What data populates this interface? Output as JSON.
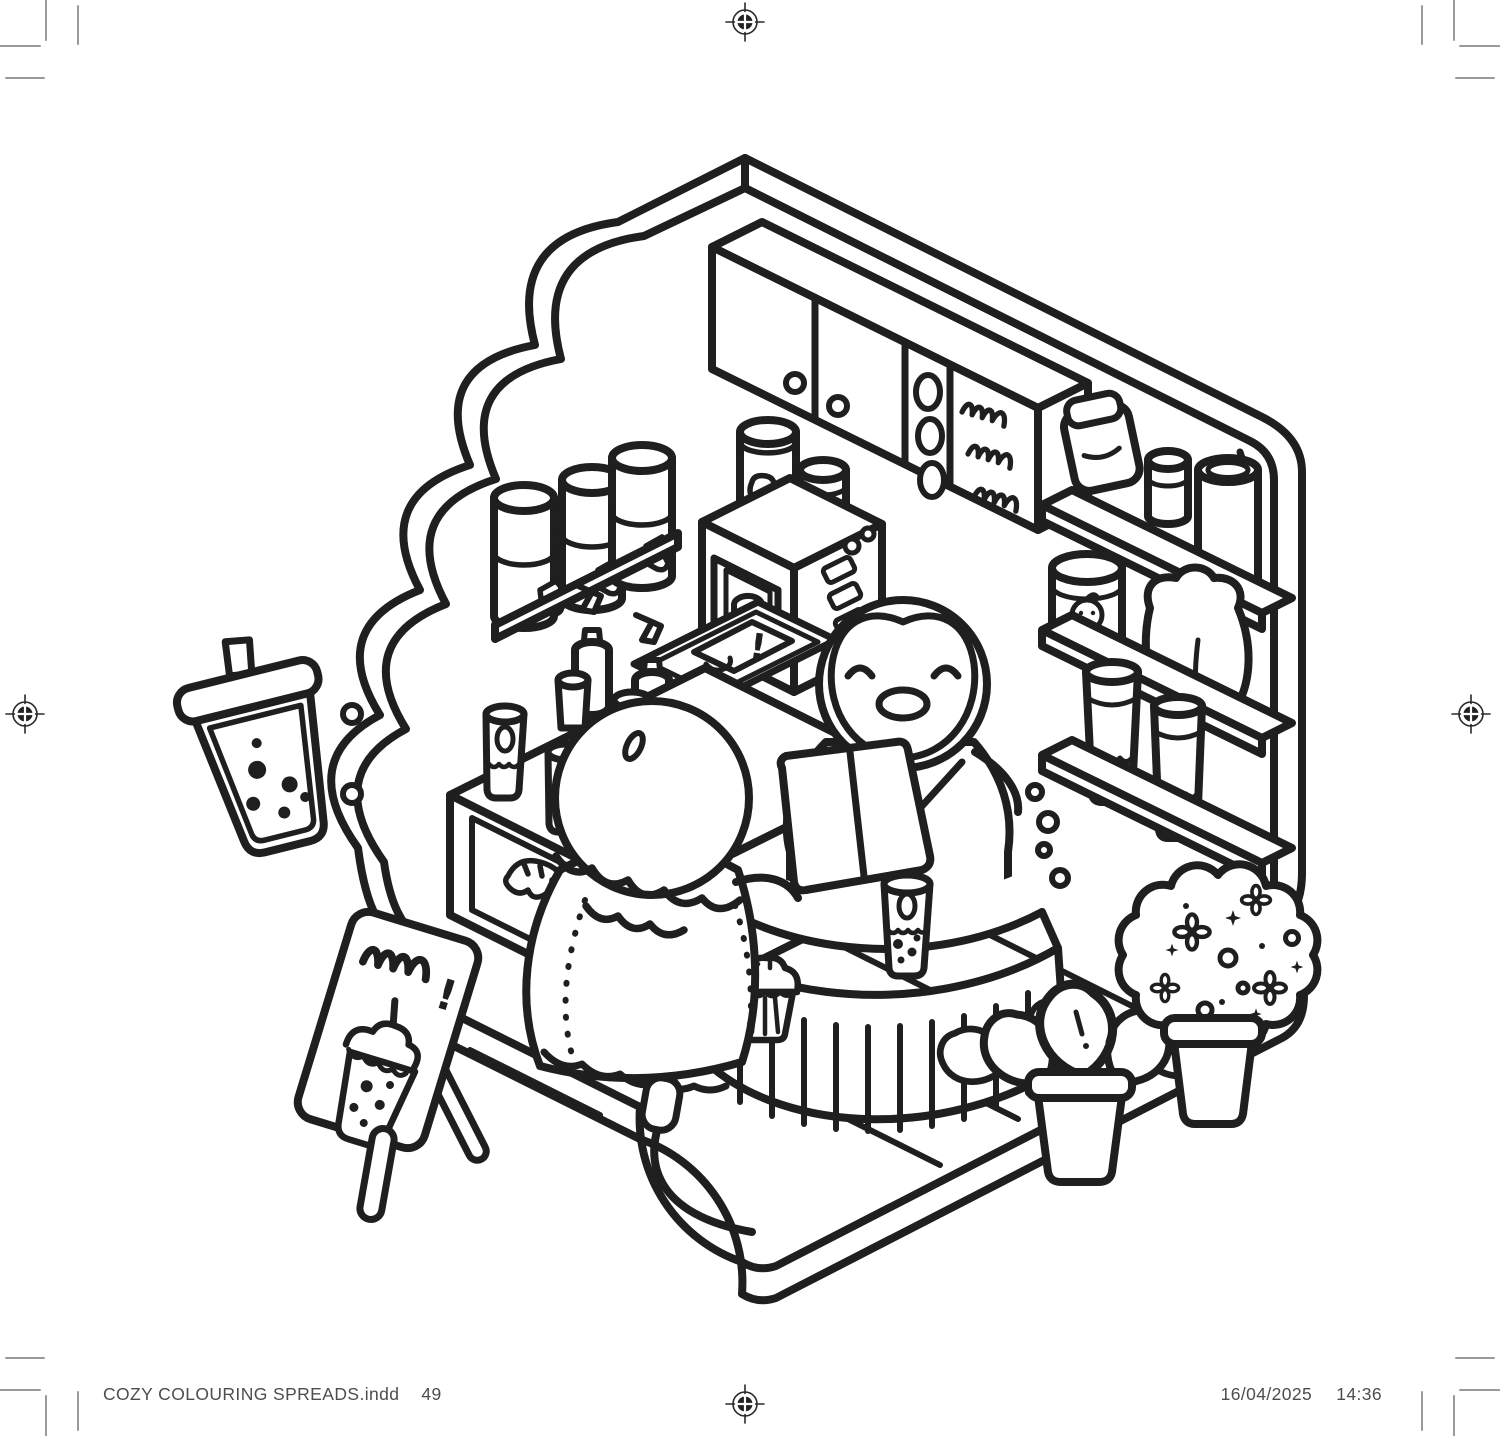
{
  "page": {
    "background": "#ffffff",
    "ink_color": "#1f1f1f",
    "crop_mark_color": "#9a9a9a",
    "footer_text_color": "#4d4d4d"
  },
  "footer": {
    "document_name": "COZY COLOURING SPREADS.indd",
    "page_number": "49",
    "date": "16/04/2025",
    "time": "14:36"
  },
  "illustration": {
    "tray_note_mark": "!",
    "easel_sign_mark": "!"
  }
}
